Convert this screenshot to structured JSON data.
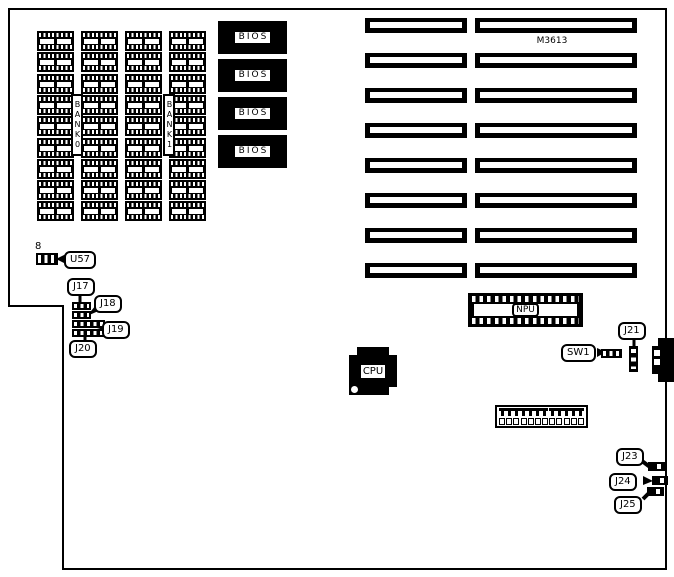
{
  "diagram": {
    "model": "M3613",
    "memory": {
      "columns": 4,
      "rows": 9,
      "bank_labels": [
        "BANK0",
        "BANK1"
      ]
    },
    "bios": {
      "count": 4,
      "label": "BIOS"
    },
    "expansion_slots": {
      "rows": 8,
      "slots_per_row": 2
    },
    "cpu": {
      "label": "CPU"
    },
    "npu": {
      "label": "NPU"
    },
    "power_connector": {
      "pins": 12
    },
    "pin8_label": "8",
    "callouts": {
      "u57": "U57",
      "j17": "J17",
      "j18": "J18",
      "j19": "J19",
      "j20": "J20",
      "j21": "J21",
      "sw1": "SW1",
      "j23": "J23",
      "j24": "J24",
      "j25": "J25"
    }
  }
}
